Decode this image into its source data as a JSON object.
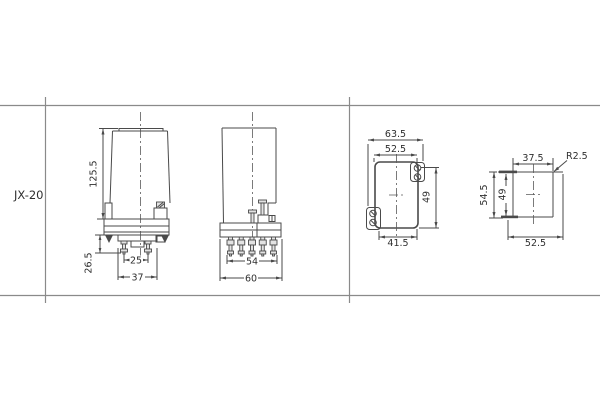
{
  "colors": {
    "background": "#ffffff",
    "drawing_line": "#4a4a4a",
    "table_line": "#8a8a8a",
    "text": "#2f2f2f"
  },
  "drawing": {
    "row_label": "JX-20",
    "side_view": {
      "overall_height": "125.5",
      "pin_length": "26.5",
      "pin_spacing": "25",
      "socket_width": "37"
    },
    "front_view": {
      "pin_row_width": "54",
      "base_width": "60"
    },
    "cutout_front_view": {
      "overall_width": "63.5",
      "cutout_width": "52.5",
      "hole_span_height": "49",
      "bottom_width": "41.5"
    },
    "cutout_side_view": {
      "top_width": "37.5",
      "corner_radius": "R2.5",
      "overall_height": "54.5",
      "cutout_height": "49",
      "bottom_width": "52.5"
    }
  }
}
